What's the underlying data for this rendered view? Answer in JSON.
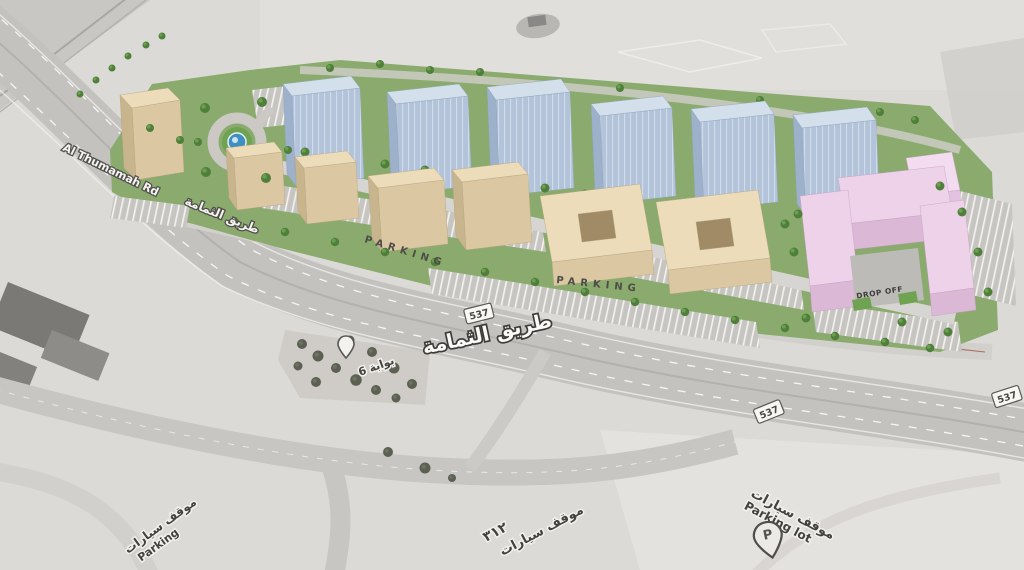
{
  "labels": {
    "road_en": "Al Thumamah Rd",
    "road_ar_small": "طريق الثمامة",
    "road_ar_large": "طريق الثمامة",
    "route_shield": "537",
    "parking": "PARKING",
    "drop_off": "DROP OFF",
    "gate_ar": "بوابة 6",
    "parking_lot_ar": "موقف سيارات",
    "parking_lot_en": "Parking lot",
    "pin_letter": "P",
    "plot_number_ar": "٣١٢",
    "partial_parking_ar": "موقف سيارات",
    "partial_parking_en": "Parking"
  },
  "colors": {
    "base": "#dcdad6",
    "road": "#c6c4c0",
    "site_green": "#8aab6d",
    "tree_green": "#4f7f3b",
    "tower_front": "#b3c3da",
    "tower_top": "#d3dfeb",
    "beige_front": "#dbc8a2",
    "beige_top": "#ecdcba",
    "pink_front": "#dcb8d7",
    "pink_top": "#eed2ea",
    "fountain_blue": "#3f8fc0",
    "stripe_white": "#f2f1ee"
  }
}
